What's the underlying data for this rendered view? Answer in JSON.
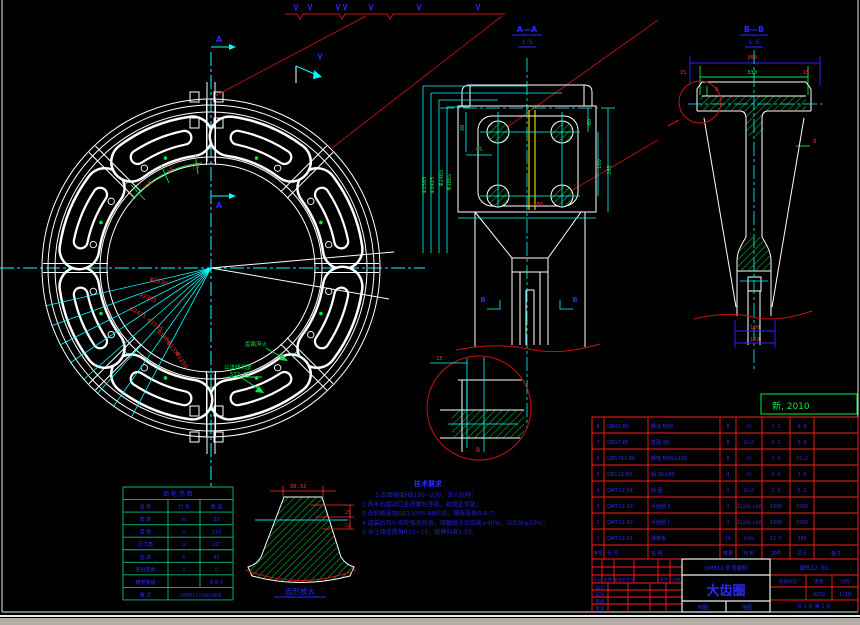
{
  "stamp": {
    "text": "新, 2010"
  },
  "sections": {
    "a": "A",
    "b": "B"
  },
  "view_titles": {
    "aa": "A—A",
    "aa_scale": "1:5",
    "bb": "B—B",
    "bb_scale": "1:5",
    "tooth_caption": "齿形放大",
    "detail_label": "B"
  },
  "main_dims": {
    "radial": [
      "Φ2230",
      "Φ2365",
      "Φ2425",
      "Φ1535",
      "Φ1460",
      "Φ1350",
      "Φ1250"
    ],
    "angles": [
      "18°",
      "18°",
      "7.5°"
    ],
    "leader1": "齿面淬火",
    "leader2a": "公法线长度",
    "leader2b": "577.52"
  },
  "aa_dims": {
    "d30": "30",
    "d45": "45",
    "d60": "60",
    "d100": "100",
    "d265": "265",
    "d200": "200",
    "left": [
      "Φ2365",
      "Φ2425",
      "Φ2465",
      "Φ1865"
    ]
  },
  "bb_dims": {
    "d360": "360",
    "d330": "330",
    "d15l": "15",
    "d15r": "15",
    "d8a": "8",
    "d8b": "8",
    "d100": "100",
    "d120": "120"
  },
  "detail_dims": {
    "d15": "15"
  },
  "tooth_dims": {
    "w": "30.32",
    "h1": "25",
    "h2": "52"
  },
  "tech_notes": {
    "heading": "技术要求",
    "lines": [
      "1.齿面硬度HB190~230，正火处理；",
      "2.两半齿圈对口处用螺栓连接，按规定预紧；",
      "3.齿轮精度按GB10095-88检验，精度等级8-8-7；",
      "4.组装后与小齿轮啮合检查，接触斑点沿齿高≥40%，沿齿长≥50%；",
      "5.未注铸造圆角R10~15，拔模斜度1:20。"
    ]
  },
  "param_table": {
    "title": "齿 轮 参 数",
    "header": [
      "名 称",
      "代 号",
      "数 值"
    ],
    "rows": [
      [
        "模  数",
        "m",
        "20"
      ],
      [
        "齿  数",
        "z",
        "110"
      ],
      [
        "压力角",
        "α",
        "20°"
      ],
      [
        "齿  高",
        "h",
        "45"
      ],
      [
        "变位系数",
        "x",
        "0"
      ],
      [
        "精度等级",
        "",
        "8-8-7"
      ]
    ],
    "note_label": "备 注",
    "note_value": "与QM512-02配对使用"
  },
  "bom": {
    "headers": [
      "序号",
      "代 号",
      "名 称",
      "数量",
      "材 料",
      "单件",
      "总计",
      "备注"
    ],
    "rows": [
      [
        "8",
        "GB41-86",
        "螺母 M36",
        "8",
        "45",
        "1.1",
        "8.8",
        ""
      ],
      [
        "7",
        "GB97-85",
        "垫圈 36",
        "8",
        "Q235",
        "0.1",
        "0.8",
        ""
      ],
      [
        "6",
        "GB5782-86",
        "螺栓 M36×200",
        "8",
        "45",
        "1.9",
        "15.2",
        ""
      ],
      [
        "5",
        "GB119-86",
        "销 30×80",
        "4",
        "35",
        "0.4",
        "1.6",
        ""
      ],
      [
        "4",
        "QM512-04",
        "挡 圈",
        "2",
        "Q235",
        "2.6",
        "5.2",
        ""
      ],
      [
        "3",
        "QM512-03",
        "半齿圈 Ⅱ",
        "1",
        "ZG340-640",
        "1930",
        "1930",
        ""
      ],
      [
        "2",
        "QM512-02",
        "半齿圈 Ⅰ",
        "1",
        "ZG340-640",
        "1930",
        "1930",
        ""
      ],
      [
        "1",
        "QM512-01",
        "弹簧板",
        "16",
        "65Mn",
        "12.5",
        "200",
        ""
      ]
    ]
  },
  "title_block": {
    "company": "QM512 矿渣磨机",
    "title": "大齿圈",
    "drawing_no": "QM512-01",
    "stage_label": "阶段标记",
    "weight_label": "重量",
    "scale_label": "比例",
    "weight": "8250",
    "scale": "1:10",
    "sheet": "共 1 张  第 1 张",
    "rev_header": [
      "标记",
      "处数",
      "更改文件号",
      "签字",
      "日期"
    ],
    "sig_rows": [
      "设计",
      "校对",
      "审核",
      "批准"
    ],
    "draw_label": "制图",
    "trace_label": "描图"
  }
}
